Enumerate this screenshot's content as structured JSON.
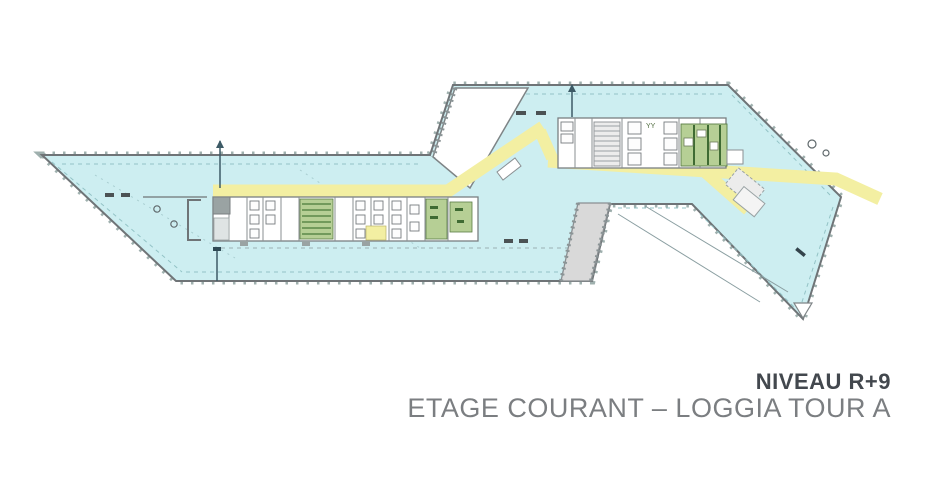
{
  "title": {
    "line1": "NIVEAU R+9",
    "line2": "ETAGE COURANT – LOGGIA TOUR A"
  },
  "plan": {
    "elevator_lobby_mark": "YY",
    "colors": {
      "floor_area": "#cdeef1",
      "circulation": "#f3efa2",
      "planted_technical": "#b6cf95",
      "loggia_gray": "#d9d9d9",
      "outline": "#6f7477",
      "facade_ticks": "#9fb0ae",
      "title_primary": "#43484e",
      "title_secondary": "#7b7e81"
    }
  }
}
